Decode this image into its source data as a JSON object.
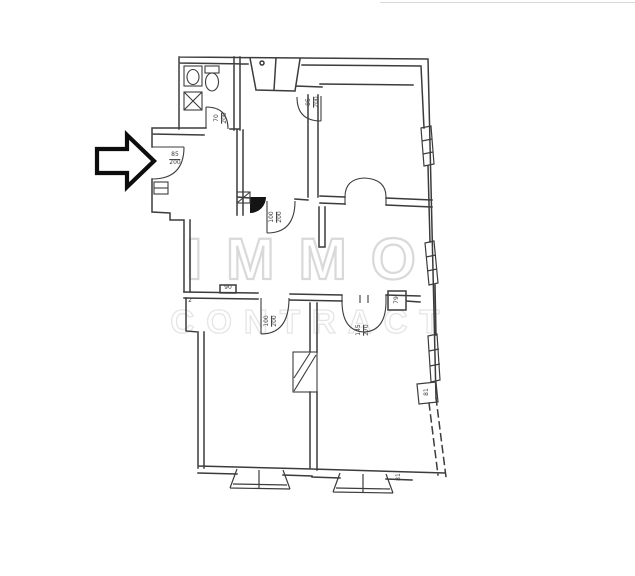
{
  "meta": {
    "type": "floor-plan",
    "description": "Scanned apartment floor plan with black entrance arrow and agency watermark"
  },
  "watermark": {
    "line1": "IMMO",
    "line2": "CONTRACT"
  },
  "arrow": {
    "meaning": "entrance-indicator"
  },
  "colors": {
    "background": "#ffffff",
    "plan_line": "#3c3c3c",
    "watermark_primary": "#d9d9d9",
    "watermark_secondary": "#e5e5e5",
    "arrow_outline": "#0d0d0d",
    "door_fill_black": "#141414"
  },
  "dimension_labels": [
    {
      "name": "entrance-door-size",
      "lines": [
        "85",
        "200"
      ],
      "x": 175,
      "y": 159,
      "rotate": 0
    },
    {
      "name": "bathroom-door-size",
      "lines": [
        "70",
        "200"
      ],
      "x": 221,
      "y": 118,
      "rotate": -90
    },
    {
      "name": "room-top-right-door-size",
      "lines": [
        "85",
        "200"
      ],
      "x": 313,
      "y": 102,
      "rotate": -90
    },
    {
      "name": "kitchen-door-size",
      "lines": [
        "100",
        "200"
      ],
      "x": 276,
      "y": 217,
      "rotate": -90
    },
    {
      "name": "room-bottom-left-door-size",
      "lines": [
        "100",
        "200"
      ],
      "x": 271,
      "y": 321,
      "rotate": -90
    },
    {
      "name": "double-door-size",
      "lines": [
        "145",
        "270"
      ],
      "x": 363,
      "y": 330,
      "rotate": -90
    },
    {
      "name": "niche-width",
      "lines": [
        "79"
      ],
      "x": 397,
      "y": 300,
      "rotate": -90
    },
    {
      "name": "pier-width-right-wall",
      "lines": [
        "81"
      ],
      "x": 427,
      "y": 392,
      "rotate": -90
    },
    {
      "name": "pier-width-bottom-wall",
      "lines": [
        "81"
      ],
      "x": 399,
      "y": 477,
      "rotate": -90
    },
    {
      "name": "wall-mark-90",
      "lines": [
        "90"
      ],
      "x": 228,
      "y": 288,
      "rotate": 0
    },
    {
      "name": "wall-mark-2",
      "lines": [
        "2"
      ],
      "x": 190,
      "y": 301,
      "rotate": 0
    }
  ]
}
